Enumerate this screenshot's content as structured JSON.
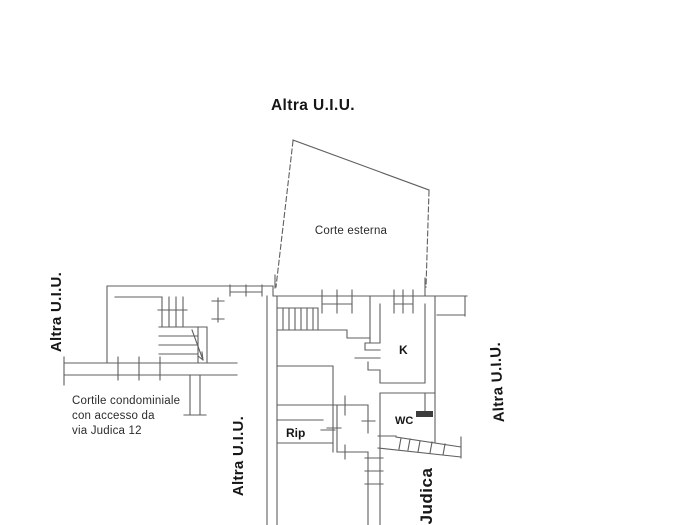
{
  "plan": {
    "title": "Planimetria catastale",
    "labels": {
      "altra_top": "Altra U.I.U.",
      "altra_left": "Altra U.I.U.",
      "altra_bottom_left": "Altra U.I.U.",
      "altra_right": "Altra U.I.U.",
      "corte_esterna": "Corte esterna",
      "cortile_line1": "Cortile condominiale",
      "cortile_line2": "con accesso da",
      "cortile_line3": "via Judica 12",
      "street": "Judica",
      "room_k": "K",
      "room_wc": "WC",
      "room_rip": "Rip"
    },
    "colors": {
      "background": "#ffffff",
      "line": "#5f5f5f",
      "line_light": "#7a7a7a",
      "dark_fill": "#3d3d3d",
      "text": "#161616",
      "text_secondary": "#2b2b2b"
    }
  }
}
